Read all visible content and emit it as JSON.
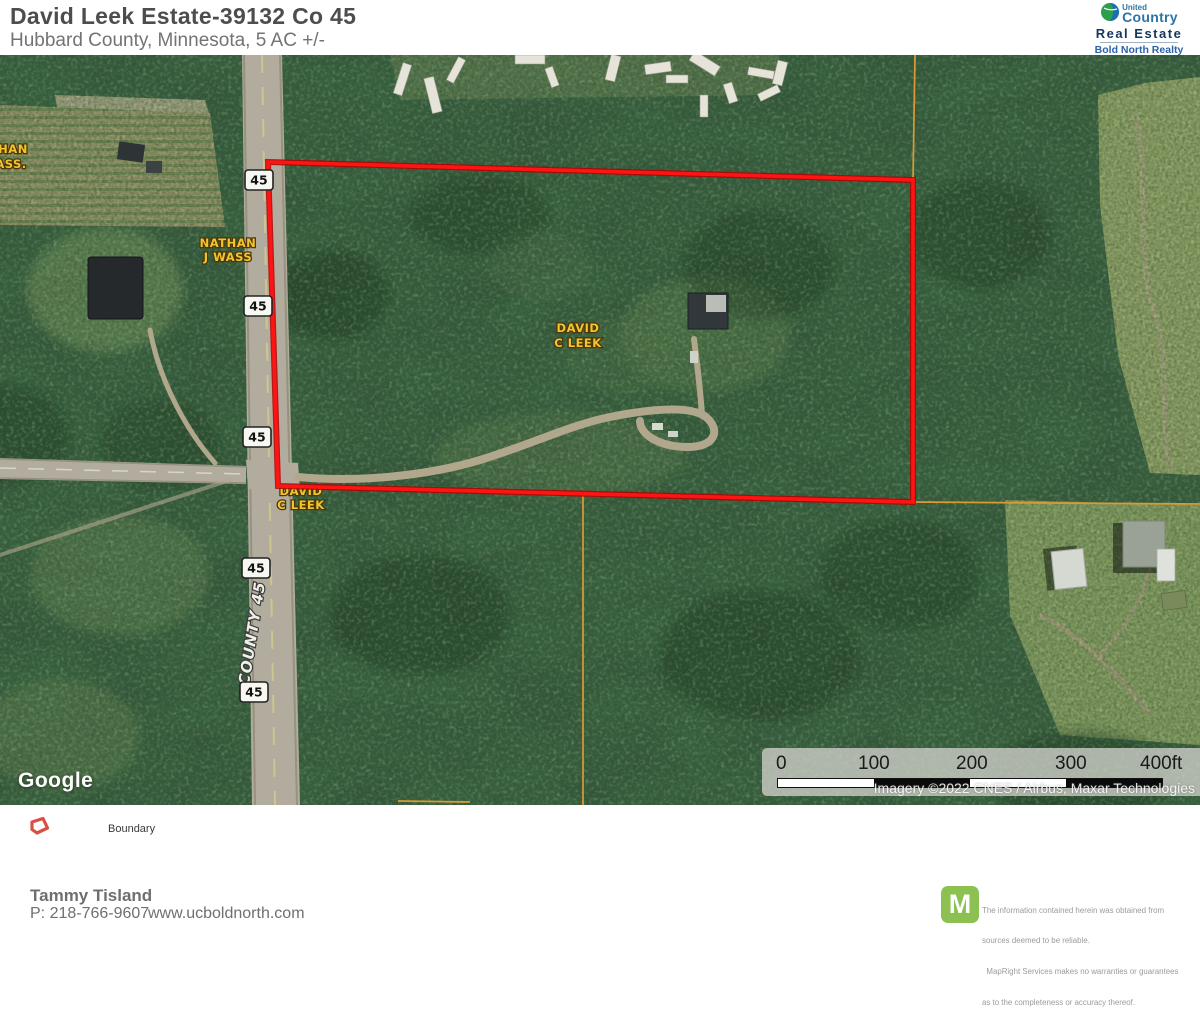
{
  "header": {
    "title": "David Leek Estate-39132 Co 45",
    "subtitle": "Hubbard County, Minnesota, 5 AC +/-"
  },
  "logo": {
    "brand_small": "United",
    "brand_large": "Country",
    "division": "Real Estate",
    "office_line1": "Bold North Realty",
    "office_line2": "& Auctions, LLC"
  },
  "map": {
    "labels": {
      "owner_nw_line1": "NATHAN",
      "owner_nw_line2": "J WASS",
      "owner_edge_line1": "HAN",
      "owner_edge_line2": "ASS.",
      "owner_center_line1": "DAVID",
      "owner_center_line2": "C LEEK",
      "owner_road_line1": "DAVID",
      "owner_road_line2": "C LEEK",
      "county_road": "COUNTY 45",
      "route_shield": "45"
    },
    "google_logo": "Google",
    "scale": {
      "ticks": [
        "0",
        "100",
        "200",
        "300",
        "400ft"
      ]
    },
    "attribution": "Imagery ©2022 CNES / Airbus, Maxar Technologies",
    "colors": {
      "boundary_red": "#ff1414",
      "parcel_orange": "#dd9a33",
      "owner_label_yellow": "#f4c430",
      "mapright_green": "#8cc152"
    }
  },
  "legend": {
    "boundary_label": "Boundary"
  },
  "footer": {
    "agent_name": "Tammy Tisland",
    "agent_phone": "P: 218-766-9607",
    "website": "www.ucboldnorth.com",
    "mapright_letter": "M",
    "disclaimer_line1": "The information contained herein was obtained from",
    "disclaimer_line2": "sources deemed to be reliable.",
    "disclaimer_line3": "  MapRight Services makes no warranties or guarantees",
    "disclaimer_line4": "as to the completeness or accuracy thereof."
  }
}
